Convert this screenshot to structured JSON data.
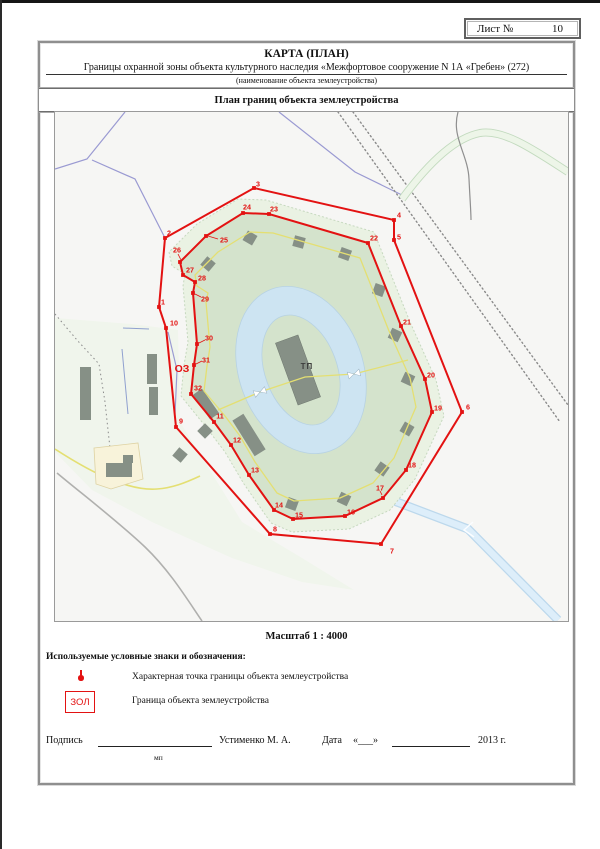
{
  "sheet": {
    "label": "Лист №",
    "number": "10"
  },
  "header": {
    "title": "КАРТА (ПЛАН)",
    "subtitle": "Границы охранной зоны объекта культурного наследия «Межфортовое сооружение N 1А «Гребен» (272)",
    "note": "(наименование объекта землеустройства)",
    "plan_title": "План границ объекта землеустройства"
  },
  "scale_text": "Масштаб 1 : 4000",
  "legend": {
    "heading": "Используемые условные знаки и обозначения:",
    "items": [
      {
        "symbol": "boundary-point",
        "label": "Характерная точка границы объекта землеустройства"
      },
      {
        "symbol": "zol-box",
        "symbol_text": "ЗОЛ",
        "label": "Граница объекта землеустройства"
      }
    ]
  },
  "signature": {
    "label": "Подпись",
    "name": "Устименко М. А.",
    "date_label": "Дата",
    "date_quote": "«___»",
    "year": "2013 г.",
    "stamp": "мп"
  },
  "map": {
    "viewbox": "53 110 513 509",
    "oz": {
      "text": "ОЗ",
      "x": 180,
      "y": 370
    },
    "tp": {
      "text": "ТП",
      "x": 305,
      "y": 367
    },
    "colors": {
      "bg": "#f6f6f4",
      "red": "#e31212",
      "fort_green": "#d4e3cc",
      "margin_green": "#eaf2e3",
      "moat_blue": "#cde4f2",
      "yellow": "#e4df72",
      "lavender": "#9a9ad2",
      "rail_gray": "#8a8a8a",
      "building_gray": "#869086",
      "pale_left": "#f0f5ec",
      "canal_blue": "#d9ecfa"
    },
    "outer_points": [
      {
        "n": "1",
        "x": 157,
        "y": 305,
        "lx": 161,
        "ly": 300
      },
      {
        "n": "2",
        "x": 163,
        "y": 236,
        "lx": 167,
        "ly": 231
      },
      {
        "n": "3",
        "x": 252,
        "y": 186,
        "lx": 256,
        "ly": 182
      },
      {
        "n": "4",
        "x": 392,
        "y": 218,
        "lx": 397,
        "ly": 213
      },
      {
        "n": "5",
        "x": 392,
        "y": 238,
        "lx": 397,
        "ly": 235
      },
      {
        "n": "6",
        "x": 460,
        "y": 410,
        "lx": 466,
        "ly": 405
      },
      {
        "n": "7",
        "x": 379,
        "y": 542,
        "lx": 390,
        "ly": 549
      },
      {
        "n": "8",
        "x": 268,
        "y": 532,
        "lx": 273,
        "ly": 527
      },
      {
        "n": "9",
        "x": 174,
        "y": 425,
        "lx": 179,
        "ly": 419
      },
      {
        "n": "10",
        "x": 164,
        "y": 326,
        "lx": 172,
        "ly": 321
      }
    ],
    "inner_points": [
      {
        "n": "11",
        "x": 212,
        "y": 420,
        "lx": 218,
        "ly": 414
      },
      {
        "n": "12",
        "x": 229,
        "y": 443,
        "lx": 235,
        "ly": 438
      },
      {
        "n": "13",
        "x": 247,
        "y": 473,
        "lx": 253,
        "ly": 468
      },
      {
        "n": "14",
        "x": 272,
        "y": 508,
        "lx": 277,
        "ly": 503
      },
      {
        "n": "15",
        "x": 291,
        "y": 517,
        "lx": 297,
        "ly": 513
      },
      {
        "n": "16",
        "x": 343,
        "y": 514,
        "lx": 349,
        "ly": 510
      },
      {
        "n": "17",
        "x": 381,
        "y": 496,
        "lx": 378,
        "ly": 486
      },
      {
        "n": "18",
        "x": 404,
        "y": 468,
        "lx": 410,
        "ly": 463
      },
      {
        "n": "19",
        "x": 430,
        "y": 410,
        "lx": 436,
        "ly": 406
      },
      {
        "n": "20",
        "x": 423,
        "y": 377,
        "lx": 429,
        "ly": 373
      },
      {
        "n": "21",
        "x": 399,
        "y": 324,
        "lx": 405,
        "ly": 320
      },
      {
        "n": "22",
        "x": 366,
        "y": 241,
        "lx": 372,
        "ly": 236
      },
      {
        "n": "23",
        "x": 267,
        "y": 212,
        "lx": 272,
        "ly": 207
      },
      {
        "n": "24",
        "x": 241,
        "y": 211,
        "lx": 245,
        "ly": 205
      },
      {
        "n": "25",
        "x": 204,
        "y": 234,
        "lx": 222,
        "ly": 238
      },
      {
        "n": "26",
        "x": 178,
        "y": 260,
        "lx": 175,
        "ly": 248
      },
      {
        "n": "27",
        "x": 181,
        "y": 273,
        "lx": 188,
        "ly": 268
      },
      {
        "n": "28",
        "x": 193,
        "y": 280,
        "lx": 200,
        "ly": 276
      },
      {
        "n": "29",
        "x": 191,
        "y": 291,
        "lx": 203,
        "ly": 297
      },
      {
        "n": "30",
        "x": 195,
        "y": 342,
        "lx": 207,
        "ly": 336
      },
      {
        "n": "31",
        "x": 192,
        "y": 363,
        "lx": 204,
        "ly": 358
      },
      {
        "n": "32",
        "x": 189,
        "y": 392,
        "lx": 196,
        "ly": 386
      }
    ],
    "leaders": [
      [
        206,
        234,
        216,
        237
      ],
      [
        193,
        292,
        199,
        295
      ],
      [
        197,
        341,
        203,
        338
      ],
      [
        194,
        362,
        200,
        359
      ],
      [
        179,
        258,
        176,
        252
      ],
      [
        380,
        493,
        378,
        489
      ]
    ],
    "margin_poly": [
      [
        204,
        425
      ],
      [
        223,
        450
      ],
      [
        242,
        482
      ],
      [
        269,
        521
      ],
      [
        290,
        530
      ],
      [
        347,
        527
      ],
      [
        388,
        508
      ],
      [
        413,
        477
      ],
      [
        442,
        414
      ],
      [
        434,
        378
      ],
      [
        408,
        320
      ],
      [
        372,
        230
      ],
      [
        264,
        198
      ],
      [
        236,
        197
      ],
      [
        195,
        222
      ],
      [
        167,
        250
      ],
      [
        170,
        264
      ],
      [
        183,
        272
      ],
      [
        181,
        284
      ],
      [
        186,
        340
      ],
      [
        182,
        363
      ],
      [
        179,
        394
      ]
    ],
    "yellow_ring": [
      [
        223,
        414
      ],
      [
        238,
        434
      ],
      [
        253,
        460
      ],
      [
        275,
        491
      ],
      [
        292,
        499
      ],
      [
        338,
        496
      ],
      [
        371,
        481
      ],
      [
        392,
        456
      ],
      [
        414,
        405
      ],
      [
        408,
        376
      ],
      [
        387,
        329
      ],
      [
        358,
        256
      ],
      [
        271,
        231
      ],
      [
        248,
        230
      ],
      [
        216,
        250
      ],
      [
        193,
        273
      ],
      [
        195,
        284
      ],
      [
        206,
        291
      ],
      [
        204,
        300
      ],
      [
        208,
        345
      ],
      [
        205,
        364
      ],
      [
        202,
        389
      ]
    ],
    "moat": {
      "cx": 299,
      "cy": 368,
      "rot": -20,
      "orx": 62,
      "ory": 86,
      "irx": 36,
      "iry": 57
    },
    "island_building": {
      "cx": 296,
      "cy": 368,
      "w": 24,
      "h": 66,
      "rot": -20
    },
    "crossing": [
      [
        216,
        408
      ],
      [
        258,
        390
      ],
      [
        303,
        375
      ],
      [
        352,
        372
      ],
      [
        406,
        358
      ]
    ],
    "bowties": [
      [
        258,
        390,
        -20
      ],
      [
        352,
        372,
        -15
      ]
    ],
    "diamonds": [
      [
        248,
        236,
        30
      ],
      [
        297,
        240,
        15
      ],
      [
        343,
        252,
        20
      ],
      [
        206,
        262,
        40
      ],
      [
        377,
        288,
        20
      ],
      [
        393,
        333,
        25
      ],
      [
        406,
        377,
        25
      ],
      [
        405,
        427,
        30
      ],
      [
        380,
        467,
        35
      ],
      [
        342,
        497,
        25
      ],
      [
        290,
        502,
        20
      ],
      [
        203,
        429,
        45
      ],
      [
        178,
        453,
        40
      ]
    ],
    "long_buildings": [
      [
        204,
        402,
        11,
        30,
        -35
      ],
      [
        247,
        433,
        13,
        42,
        -32
      ]
    ],
    "west_rects": [
      [
        78,
        365,
        11,
        53
      ],
      [
        145,
        352,
        10,
        30
      ],
      [
        147,
        385,
        9,
        28
      ]
    ],
    "beige_plot": [
      [
        92,
        446
      ],
      [
        136,
        441
      ],
      [
        141,
        477
      ],
      [
        109,
        487
      ],
      [
        94,
        482
      ]
    ],
    "beige_buildings": [
      [
        104,
        461,
        26,
        14
      ],
      [
        121,
        453,
        10,
        8
      ]
    ],
    "pale_left_poly": [
      [
        53,
        316
      ],
      [
        130,
        322
      ],
      [
        176,
        328
      ],
      [
        178,
        420
      ],
      [
        240,
        520
      ],
      [
        300,
        556
      ],
      [
        352,
        588
      ],
      [
        300,
        580
      ],
      [
        230,
        556
      ],
      [
        150,
        520
      ],
      [
        90,
        488
      ],
      [
        53,
        450
      ]
    ],
    "lavender_lines": [
      [
        [
          123,
          110
        ],
        [
          85,
          157
        ],
        [
          53,
          167
        ]
      ],
      [
        [
          90,
          158
        ],
        [
          133,
          177
        ],
        [
          163,
          236
        ]
      ],
      [
        [
          166,
          330
        ],
        [
          175,
          368
        ],
        [
          173,
          412
        ]
      ],
      [
        [
          277,
          110
        ],
        [
          353,
          170
        ],
        [
          402,
          194
        ]
      ]
    ],
    "rail_lines": [
      [
        [
          336,
          110
        ],
        [
          558,
          420
        ]
      ],
      [
        [
          351,
          110
        ],
        [
          566,
          403
        ]
      ]
    ],
    "green_road": "M400,197 C425,163 452,136 478,131 C502,127 532,148 566,170",
    "gray_path": "M456,110 C449,135 466,152 467,177 C468,198 469,210 469,218",
    "gray_road": "M55,471 C80,492 112,516 143,545 C168,569 185,597 200,619",
    "fence_dotted": [
      [
        53,
        312
      ],
      [
        75,
        338
      ],
      [
        97,
        362
      ],
      [
        103,
        400
      ],
      [
        106,
        428
      ],
      [
        108,
        446
      ]
    ],
    "blue_field_lines": [
      [
        [
          121,
          326
        ],
        [
          147,
          327
        ]
      ],
      [
        [
          120,
          347
        ],
        [
          126,
          412
        ]
      ]
    ],
    "canal": [
      [
        387,
        497
      ],
      [
        466,
        527
      ],
      [
        556,
        618
      ]
    ],
    "yellow_road": "M53,447 C70,458 90,470 110,478 C128,485 143,488 155,487 C170,486 183,481 198,474"
  }
}
